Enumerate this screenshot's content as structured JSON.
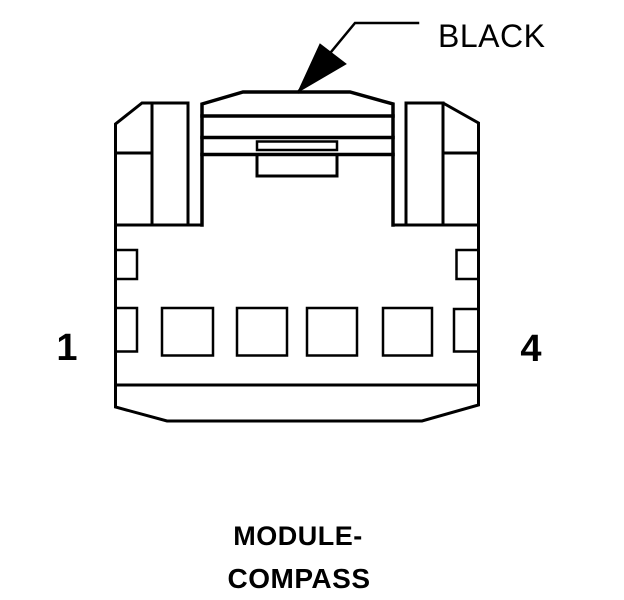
{
  "page": {
    "background_color": "#ffffff",
    "line_color": "#000000",
    "text_color": "#000000"
  },
  "connector_diagram": {
    "wire_color_label": "BLACK",
    "pin_first_label": "1",
    "pin_last_label": "4",
    "pin_cavities": 4,
    "caption_line1": "MODULE-",
    "caption_line2": "COMPASS"
  }
}
